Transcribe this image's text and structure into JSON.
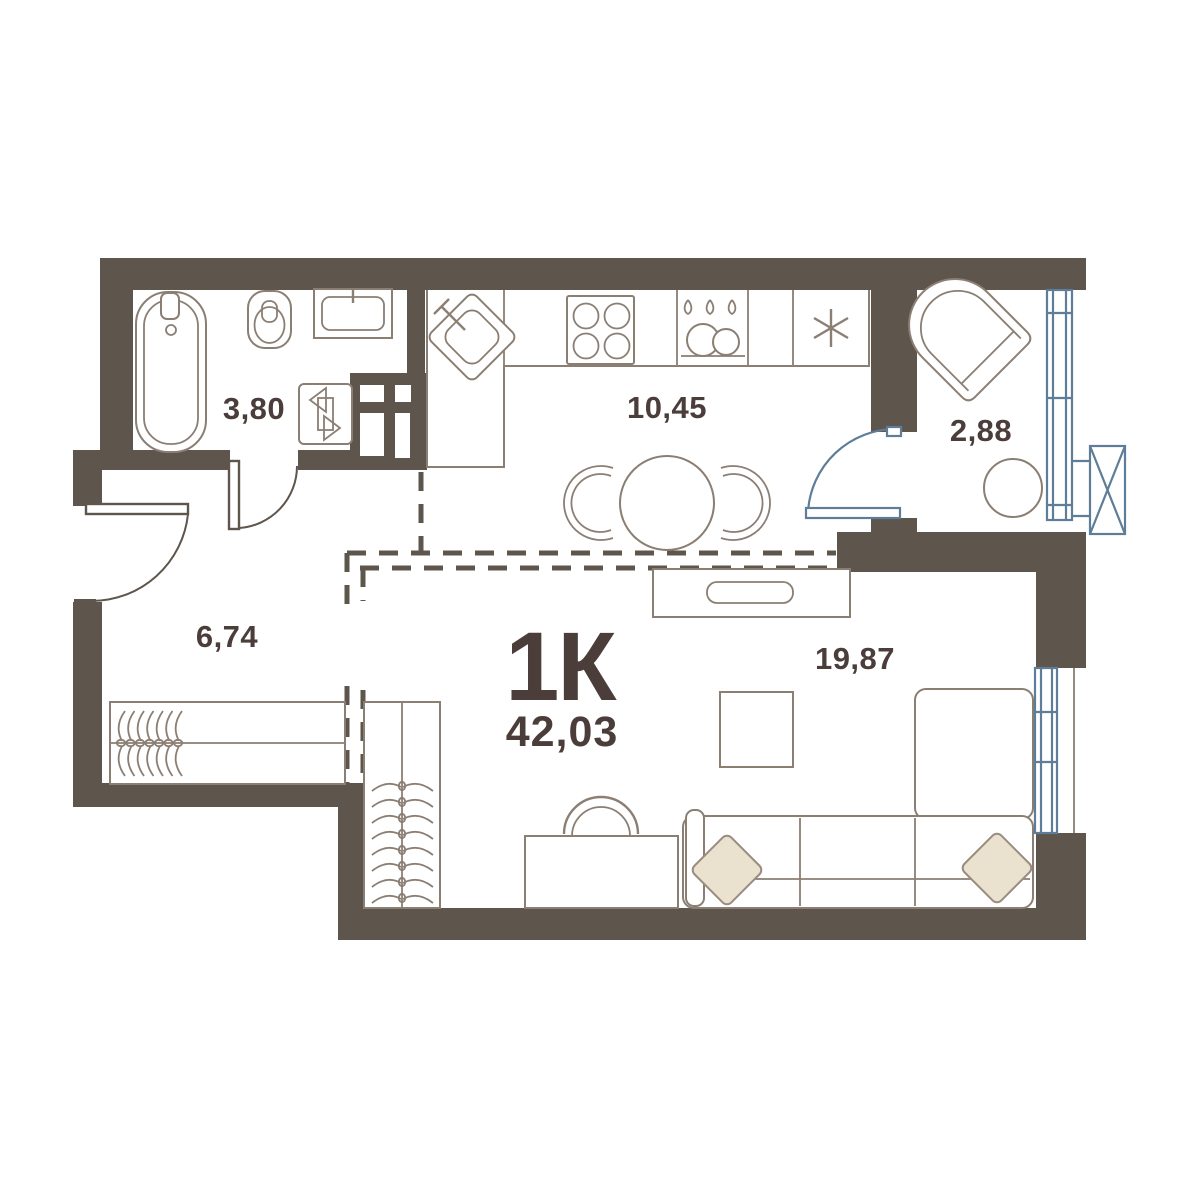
{
  "plan": {
    "apartment": {
      "type_label": "1К",
      "total_area": "42,03"
    },
    "rooms": [
      {
        "id": "bathroom",
        "area": "3,80",
        "fixtures": [
          "bathtub-icon",
          "toilet-icon",
          "bathroom-sink-icon",
          "washing-machine-icon",
          "ventilation-shaft-icon"
        ]
      },
      {
        "id": "kitchen-dining",
        "area": "10,45",
        "fixtures": [
          "kitchen-sink-icon",
          "stove-icon",
          "dish-rack-icon",
          "fridge-snowflake-icon",
          "dining-table-icon",
          "dining-chair-icon"
        ]
      },
      {
        "id": "balcony",
        "area": "2,88",
        "fixtures": [
          "armchair-icon",
          "round-table-icon",
          "balcony-glazing",
          "ac-unit-icon"
        ]
      },
      {
        "id": "hallway",
        "area": "6,74",
        "fixtures": [
          "entrance-door",
          "wardrobe-hangers-icon"
        ]
      },
      {
        "id": "living-room",
        "area": "19,87",
        "fixtures": [
          "tv-stand-icon",
          "coffee-table-icon",
          "sofa-icon",
          "pillow-icon",
          "desk-icon",
          "desk-chair-icon",
          "wardrobe-hangers-icon",
          "window-glazing"
        ]
      }
    ],
    "colors": {
      "wall": "#5e554c",
      "furniture_line": "#8b7e73",
      "text": "#4a3d3a",
      "glazing_blue": "#5d7d98",
      "pillow_fill": "#eae1ce",
      "background": "#ffffff"
    }
  }
}
